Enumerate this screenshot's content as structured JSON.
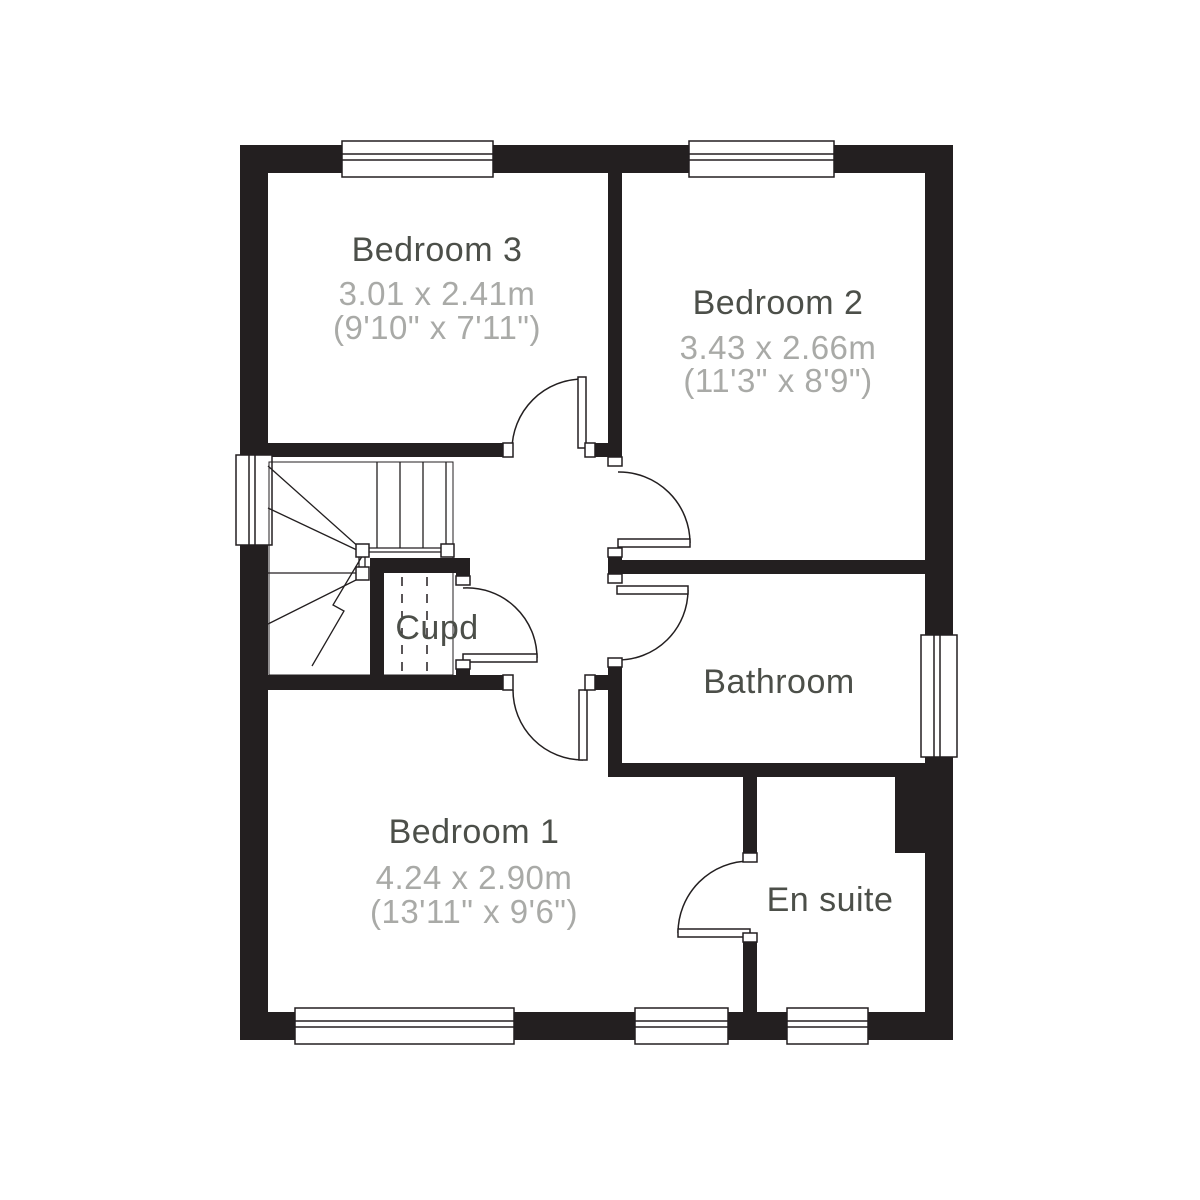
{
  "title": "First floor plan",
  "colors": {
    "wall": "#231f20",
    "line": "#231f20",
    "room_name": "#4c4f49",
    "room_dims": "#a9aaa7",
    "background": "#ffffff"
  },
  "rooms": [
    {
      "name": "Bedroom 3",
      "metric": "3.01 x 2.41m",
      "imperial": "(9'10\" x 7'11\")"
    },
    {
      "name": "Bedroom 2",
      "metric": "3.43 x 2.66m",
      "imperial": "(11'3\" x 8'9\")"
    },
    {
      "name": "Cupd"
    },
    {
      "name": "Bathroom"
    },
    {
      "name": "Bedroom 1",
      "metric": "4.24 x 2.90m",
      "imperial": "(13'11\" x 9'6\")"
    },
    {
      "name": "En suite"
    }
  ]
}
